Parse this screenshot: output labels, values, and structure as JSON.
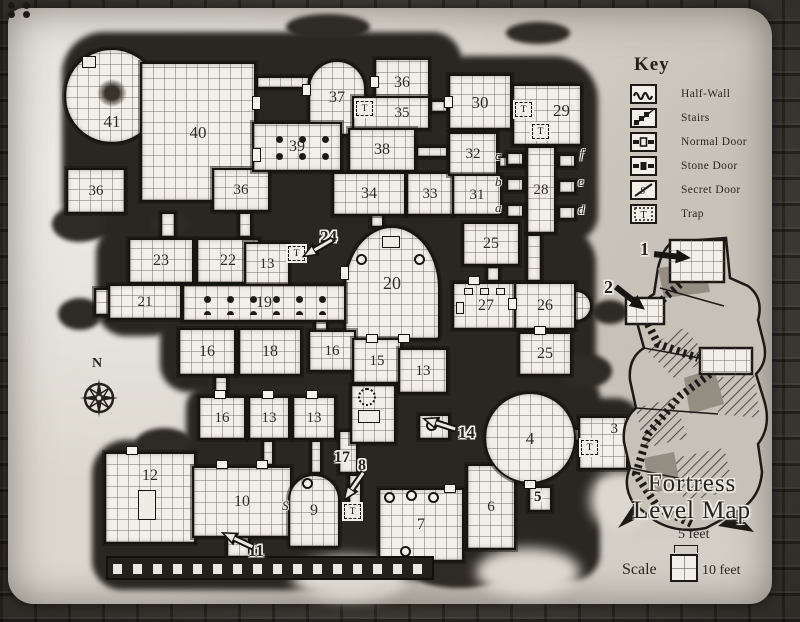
{
  "map": {
    "compass_label": "N",
    "key": {
      "title": "Key",
      "items": [
        {
          "label": "Half-Wall"
        },
        {
          "label": "Stairs"
        },
        {
          "label": "Normal Door"
        },
        {
          "label": "Stone Door"
        },
        {
          "label": "Secret Door"
        },
        {
          "label": "Trap"
        }
      ]
    },
    "title_line1": "Fortress",
    "title_line2": "Level Map",
    "scale": {
      "label": "Scale",
      "small_unit": "5 feet",
      "large_unit": "10 feet"
    },
    "markers": {
      "trap": "T",
      "secret": "S"
    },
    "cells": {
      "a": "a",
      "b": "b",
      "c": "c",
      "d": "d",
      "e": "e",
      "f": "f"
    },
    "callouts": {
      "c1": "1",
      "c2": "2",
      "c8": "8",
      "c11": "11",
      "c14": "14",
      "c17": "17",
      "c24": "24"
    },
    "rooms": [
      {
        "number": "41"
      },
      {
        "number": "40"
      },
      {
        "number": "36"
      },
      {
        "number": "36"
      },
      {
        "number": "37"
      },
      {
        "number": "36"
      },
      {
        "number": "35"
      },
      {
        "number": "39"
      },
      {
        "number": "38"
      },
      {
        "number": "34"
      },
      {
        "number": "33"
      },
      {
        "number": "30"
      },
      {
        "number": "29"
      },
      {
        "number": "32"
      },
      {
        "number": "31"
      },
      {
        "number": "28"
      },
      {
        "number": "23"
      },
      {
        "number": "22"
      },
      {
        "number": "13"
      },
      {
        "number": "20"
      },
      {
        "number": "25"
      },
      {
        "number": "27"
      },
      {
        "number": "26"
      },
      {
        "number": "25"
      },
      {
        "number": "21"
      },
      {
        "number": "19"
      },
      {
        "number": "16"
      },
      {
        "number": "18"
      },
      {
        "number": "16"
      },
      {
        "number": "15"
      },
      {
        "number": "13"
      },
      {
        "number": "16"
      },
      {
        "number": "13"
      },
      {
        "number": "13"
      },
      {
        "number": "12"
      },
      {
        "number": "10"
      },
      {
        "number": "9"
      },
      {
        "number": "7"
      },
      {
        "number": "6"
      },
      {
        "number": "4"
      },
      {
        "number": "3"
      },
      {
        "number": "5"
      }
    ]
  }
}
